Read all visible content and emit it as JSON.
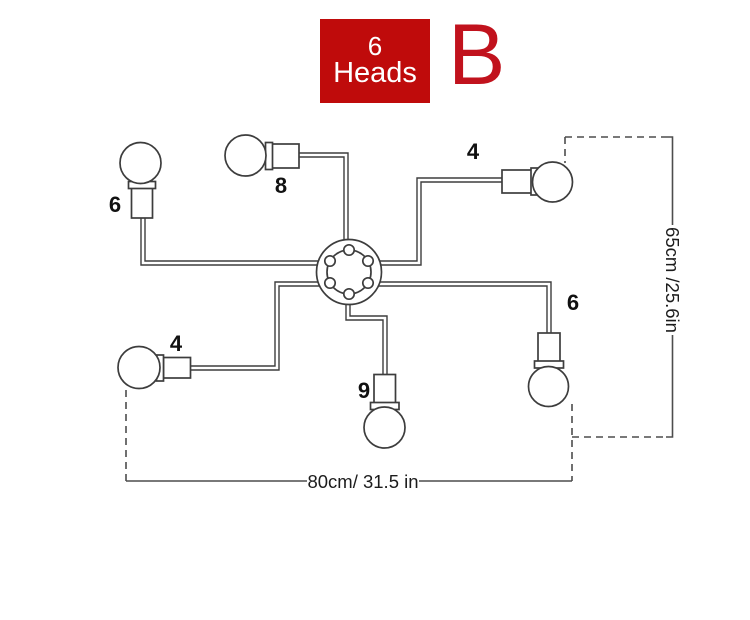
{
  "badge": {
    "count": "6",
    "label": "Heads",
    "background": "#bf0b0b",
    "text_color": "#ffffff"
  },
  "variant": {
    "letter": "B",
    "color": "#c1121d"
  },
  "diagram": {
    "type": "lamp-fixture-line-drawing",
    "heads": 6,
    "line_color": "#3d3d3d",
    "arms": [
      {
        "position": "upper-left",
        "label": "6"
      },
      {
        "position": "top",
        "label": "8"
      },
      {
        "position": "upper-right",
        "label": "4"
      },
      {
        "position": "right",
        "label": "6"
      },
      {
        "position": "lower-left",
        "label": "4"
      },
      {
        "position": "bottom",
        "label": "9"
      }
    ],
    "dimensions": {
      "height": "65cm /25.6in",
      "width": "80cm/ 31.5 in"
    }
  }
}
